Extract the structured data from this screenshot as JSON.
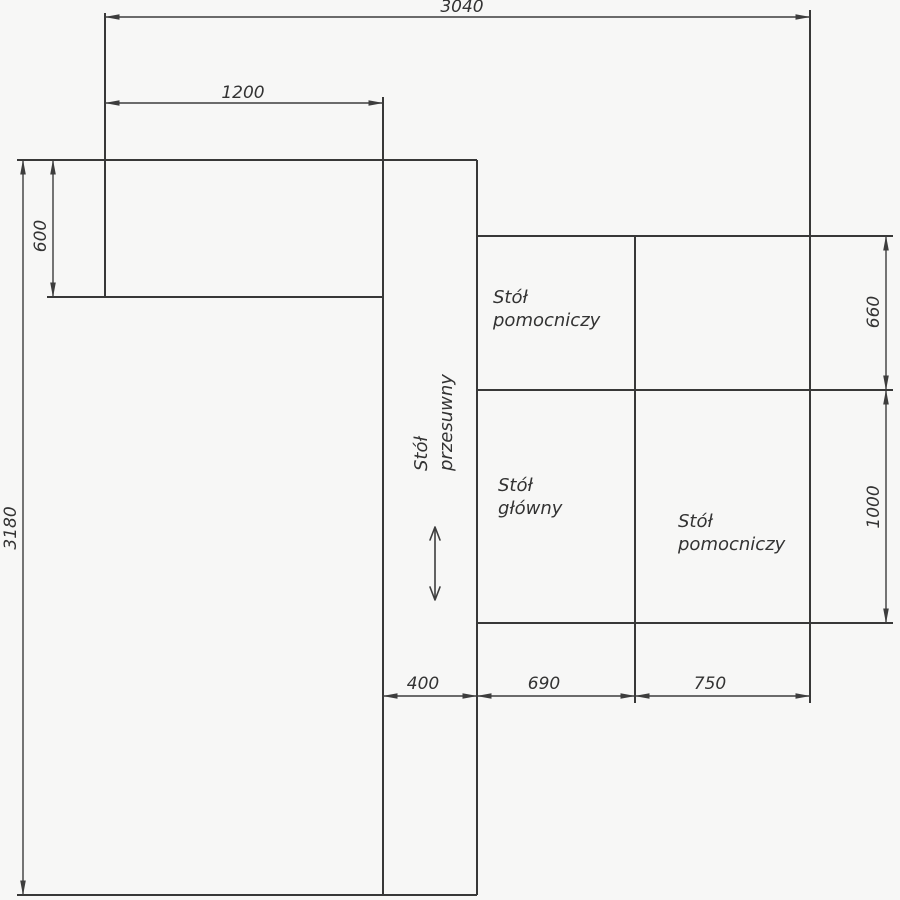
{
  "drawing": {
    "type": "workshop-table-layout-plan",
    "background_color": "#f7f7f6",
    "line_color": "#383838",
    "labels": {
      "table_aux_top": {
        "line1": "Stół",
        "line2": "pomocniczy"
      },
      "table_sliding": {
        "line1": "Stół",
        "line2": "przesuwny"
      },
      "table_main": {
        "line1": "Stół",
        "line2": "główny"
      },
      "table_aux_right": {
        "line1": "Stół",
        "line2": "pomocniczy"
      }
    },
    "dimensions": {
      "total_width": "3040",
      "left_table_width": "1200",
      "left_table_height": "600",
      "total_height": "3180",
      "aux_top_height": "660",
      "main_table_height": "1000",
      "sliding_table_width": "400",
      "main_table_width": "690",
      "aux_right_width": "750"
    }
  }
}
